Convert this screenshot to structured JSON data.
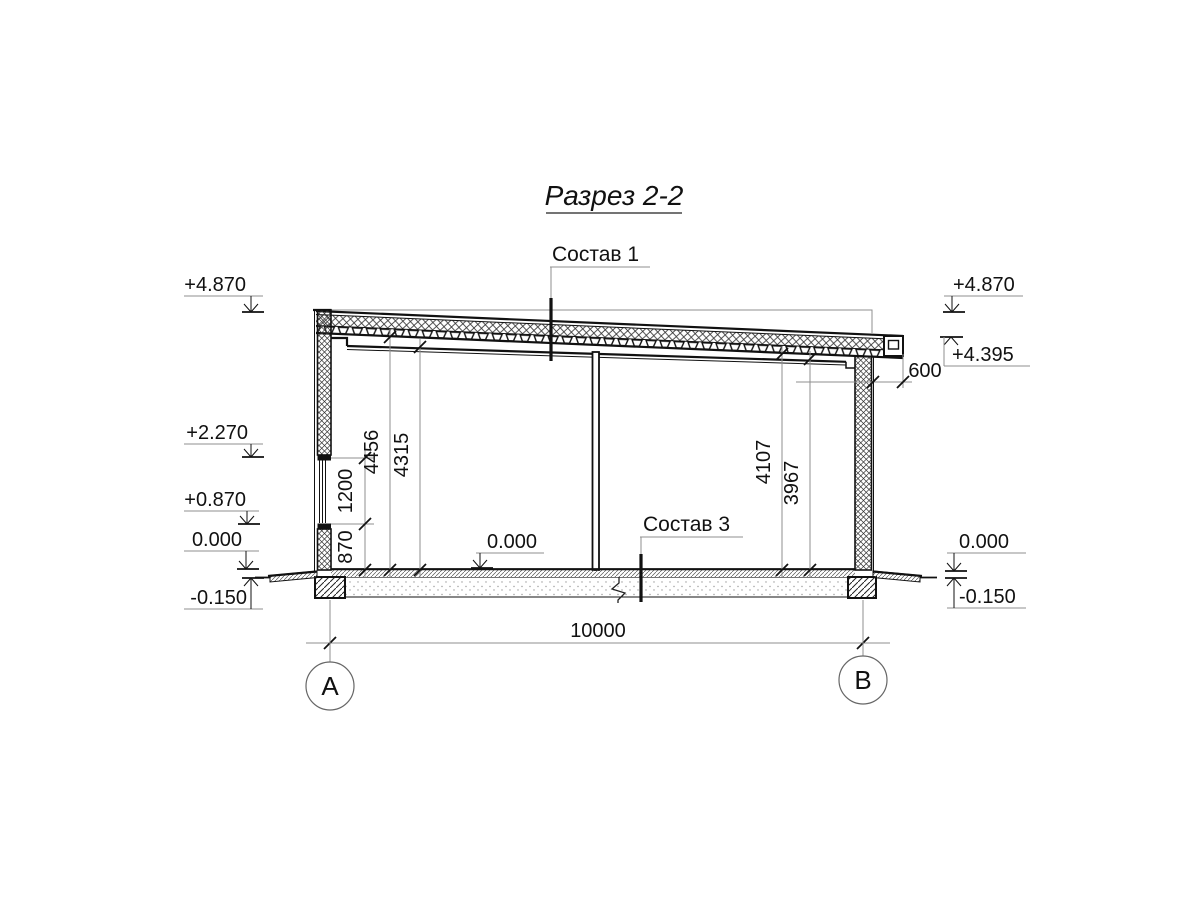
{
  "title": "Разрез 2-2",
  "callouts": {
    "roof": "Состав 1",
    "floor": "Состав 3"
  },
  "elevations": {
    "left": {
      "top": "+4.870",
      "window_top": "+2.270",
      "window_sill": "+0.870",
      "floor": "0.000",
      "grade": "-0.150"
    },
    "right": {
      "roof_high": "+4.870",
      "roof_low": "+4.395",
      "floor": "0.000",
      "grade": "-0.150"
    },
    "interior_floor": "0.000"
  },
  "dimensions": {
    "left_chain": {
      "sill_height": "870",
      "window_height": "1200"
    },
    "left_heights": {
      "to_deck": "4456",
      "to_ceiling": "4315"
    },
    "right_heights": {
      "to_deck": "4107",
      "to_ceiling": "3967"
    },
    "roof_overhang": "600",
    "span": "10000"
  },
  "grid_axes": {
    "a": "А",
    "b": "В"
  },
  "colors": {
    "line": "#111111",
    "aux": "#8f8f8f",
    "background": "#ffffff"
  }
}
